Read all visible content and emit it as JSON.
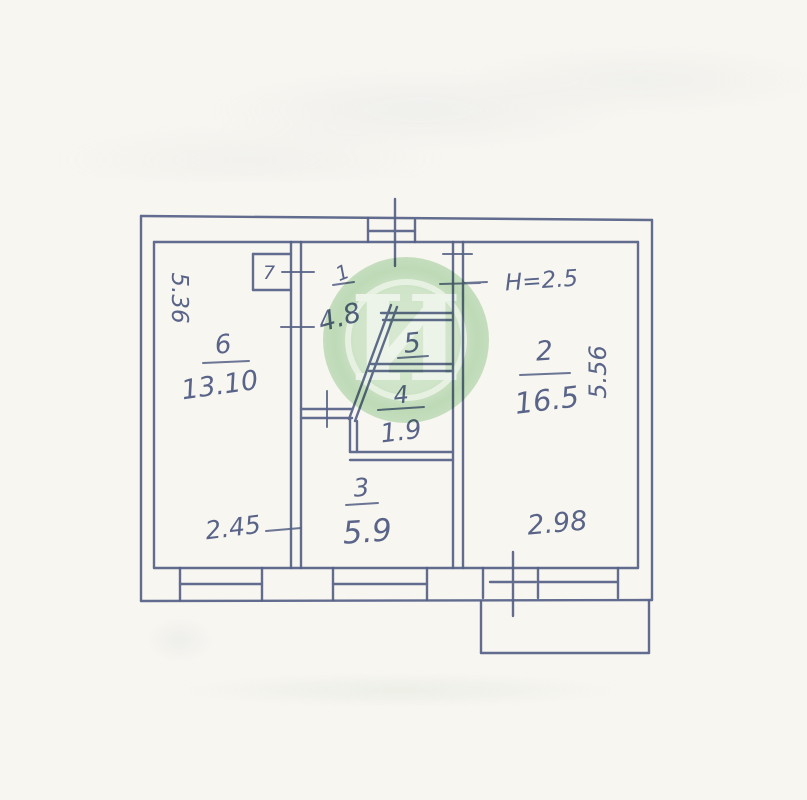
{
  "page": {
    "paper_color": "#f8f6f1",
    "ink_color": "#57648e"
  },
  "watermark": {
    "letter": "И",
    "disc_color": "#c6dfc0",
    "ring_color": "#eaf3e5"
  },
  "rooms": {
    "r1": {
      "number": "1",
      "area": "4.8"
    },
    "r2": {
      "number": "2",
      "area": "16.5"
    },
    "r3": {
      "number": "3",
      "area": "5.9"
    },
    "r4": {
      "number": "4",
      "area": "1.9"
    },
    "r5": {
      "number": "5"
    },
    "r6": {
      "number": "6",
      "area": "13.10"
    },
    "r7": {
      "number": "7"
    }
  },
  "dimensions": {
    "left_side": "5.36",
    "right_side": "5.56",
    "bottom_left": "2.45",
    "bottom_right": "2.98",
    "height_note": "Н=2.5"
  }
}
